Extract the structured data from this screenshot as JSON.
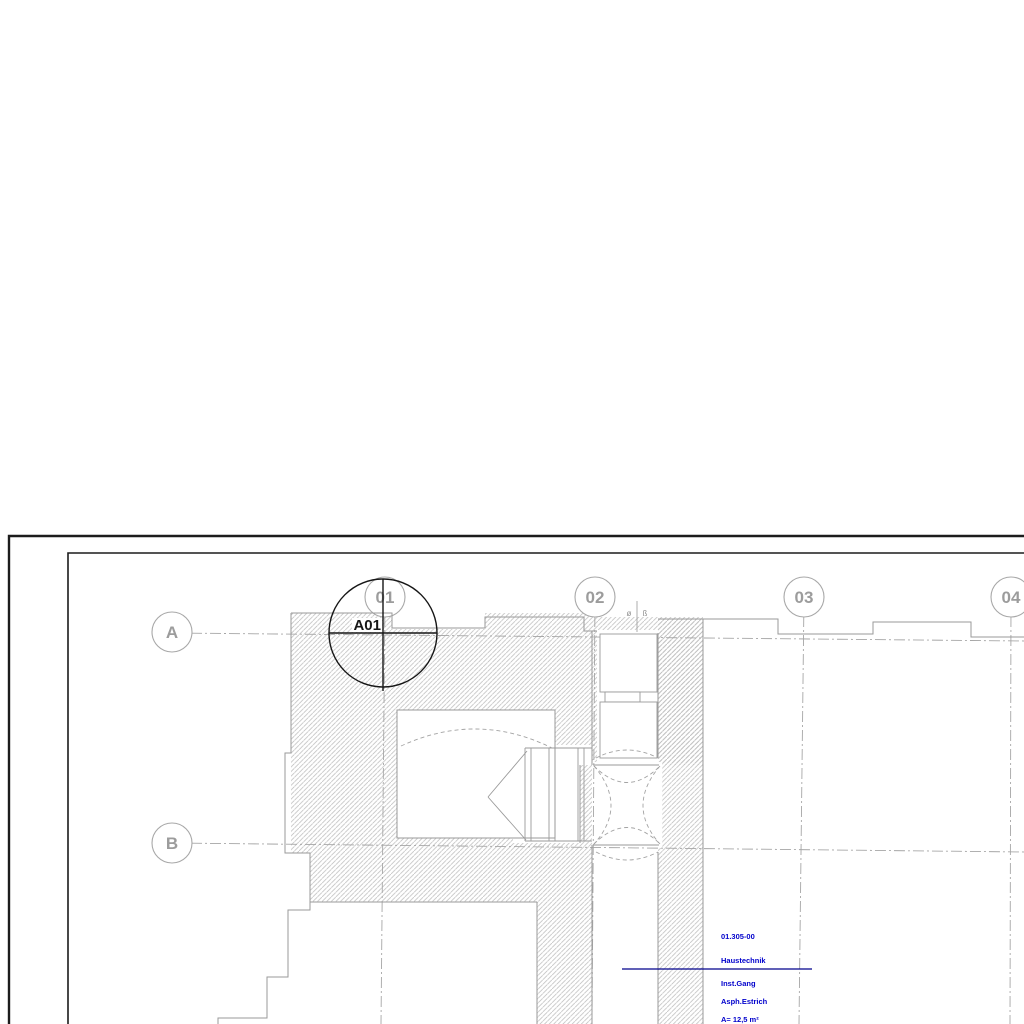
{
  "drawing": {
    "callout": {
      "label": "A01"
    },
    "grid": {
      "rows": [
        "A",
        "B"
      ],
      "cols": [
        "01",
        "02",
        "03",
        "04"
      ]
    },
    "micro_annotations": {
      "glyph_left": "ø",
      "glyph_right": "ß"
    },
    "room_stamp": {
      "number": "01.305-00",
      "name": "Haustechnik",
      "usage": "Inst.Gang",
      "floor_finish": "Asph.Estrich",
      "extra": "A= 12,5 m²"
    },
    "colors": {
      "border_black": "#1c1c1c",
      "wall_outline_gray": "#9a9a9a",
      "hatch_gray": "#bfbfbf",
      "grid_gray": "#a6a6a6",
      "callout_black": "#161616",
      "stamp_blue": "#0000cc",
      "leader_navy": "#00008c"
    }
  }
}
